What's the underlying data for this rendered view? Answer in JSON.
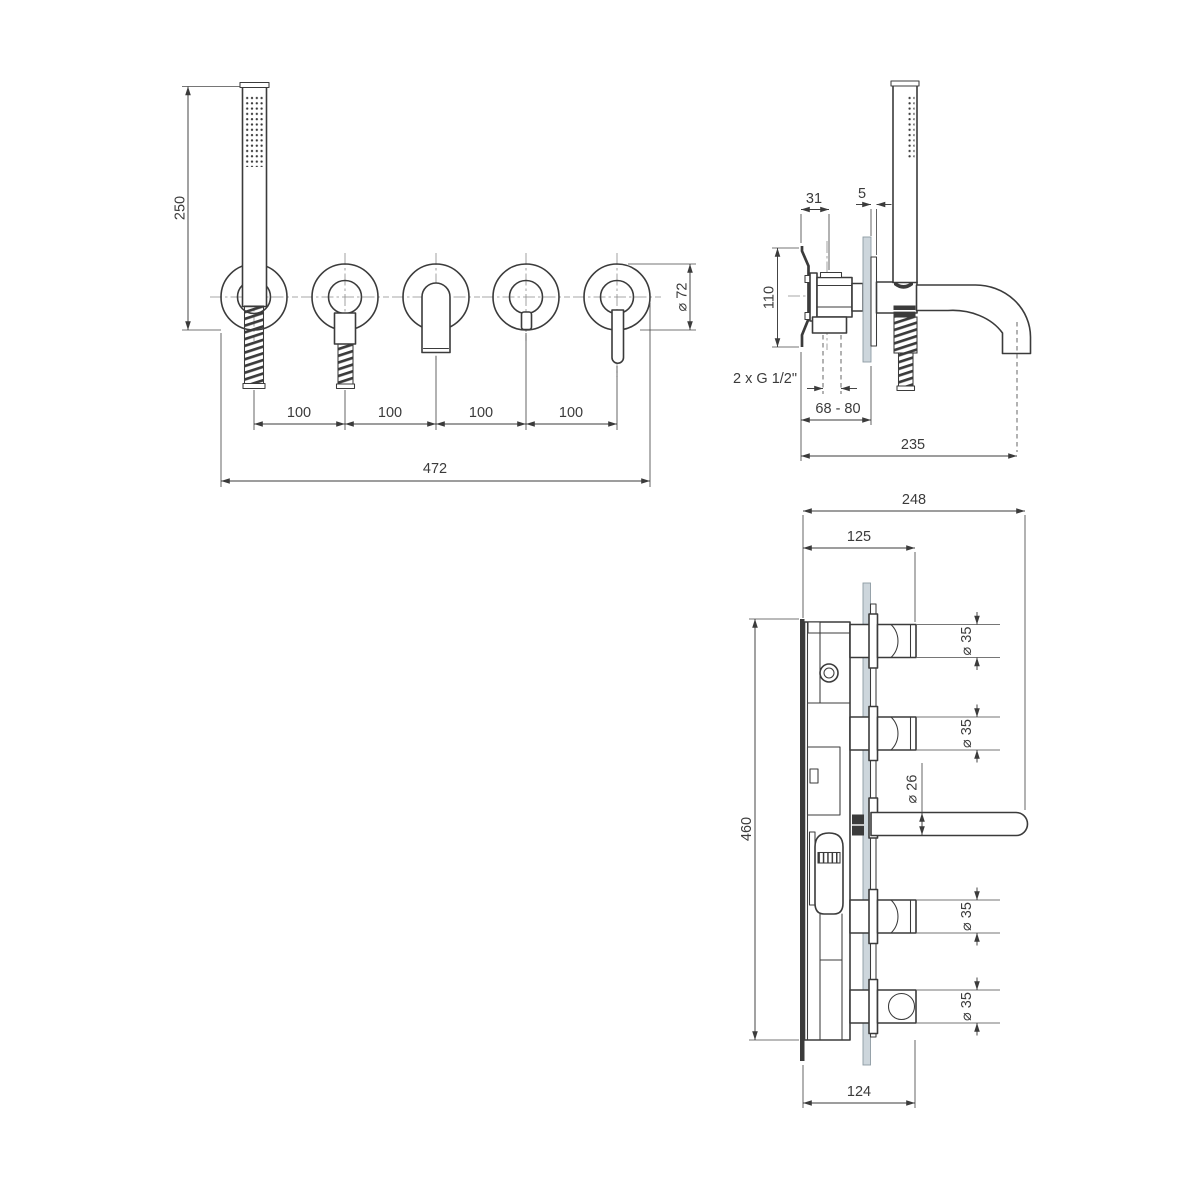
{
  "front_view": {
    "height_handshower": "250",
    "spacing": [
      "100",
      "100",
      "100",
      "100"
    ],
    "total_width": "472",
    "escutcheon_diameter": "⌀ 72"
  },
  "side_view": {
    "bracket_offset": "31",
    "trim_thickness": "5",
    "bracket_height": "110",
    "thread_label": "2 x G 1/2\"",
    "wall_depth_range": "68 - 80",
    "spout_reach": "235"
  },
  "section_view": {
    "total_depth": "248",
    "valve_depth": "125",
    "handle_diameters": [
      "⌀ 35",
      "⌀ 35",
      "⌀ 35",
      "⌀ 35"
    ],
    "spout_diameter": "⌀ 26",
    "total_height": "460",
    "bottom_depth": "124"
  },
  "colors": {
    "line": "#3b3b3b",
    "wall_plate": "#cdd6dc",
    "background": "#ffffff"
  }
}
